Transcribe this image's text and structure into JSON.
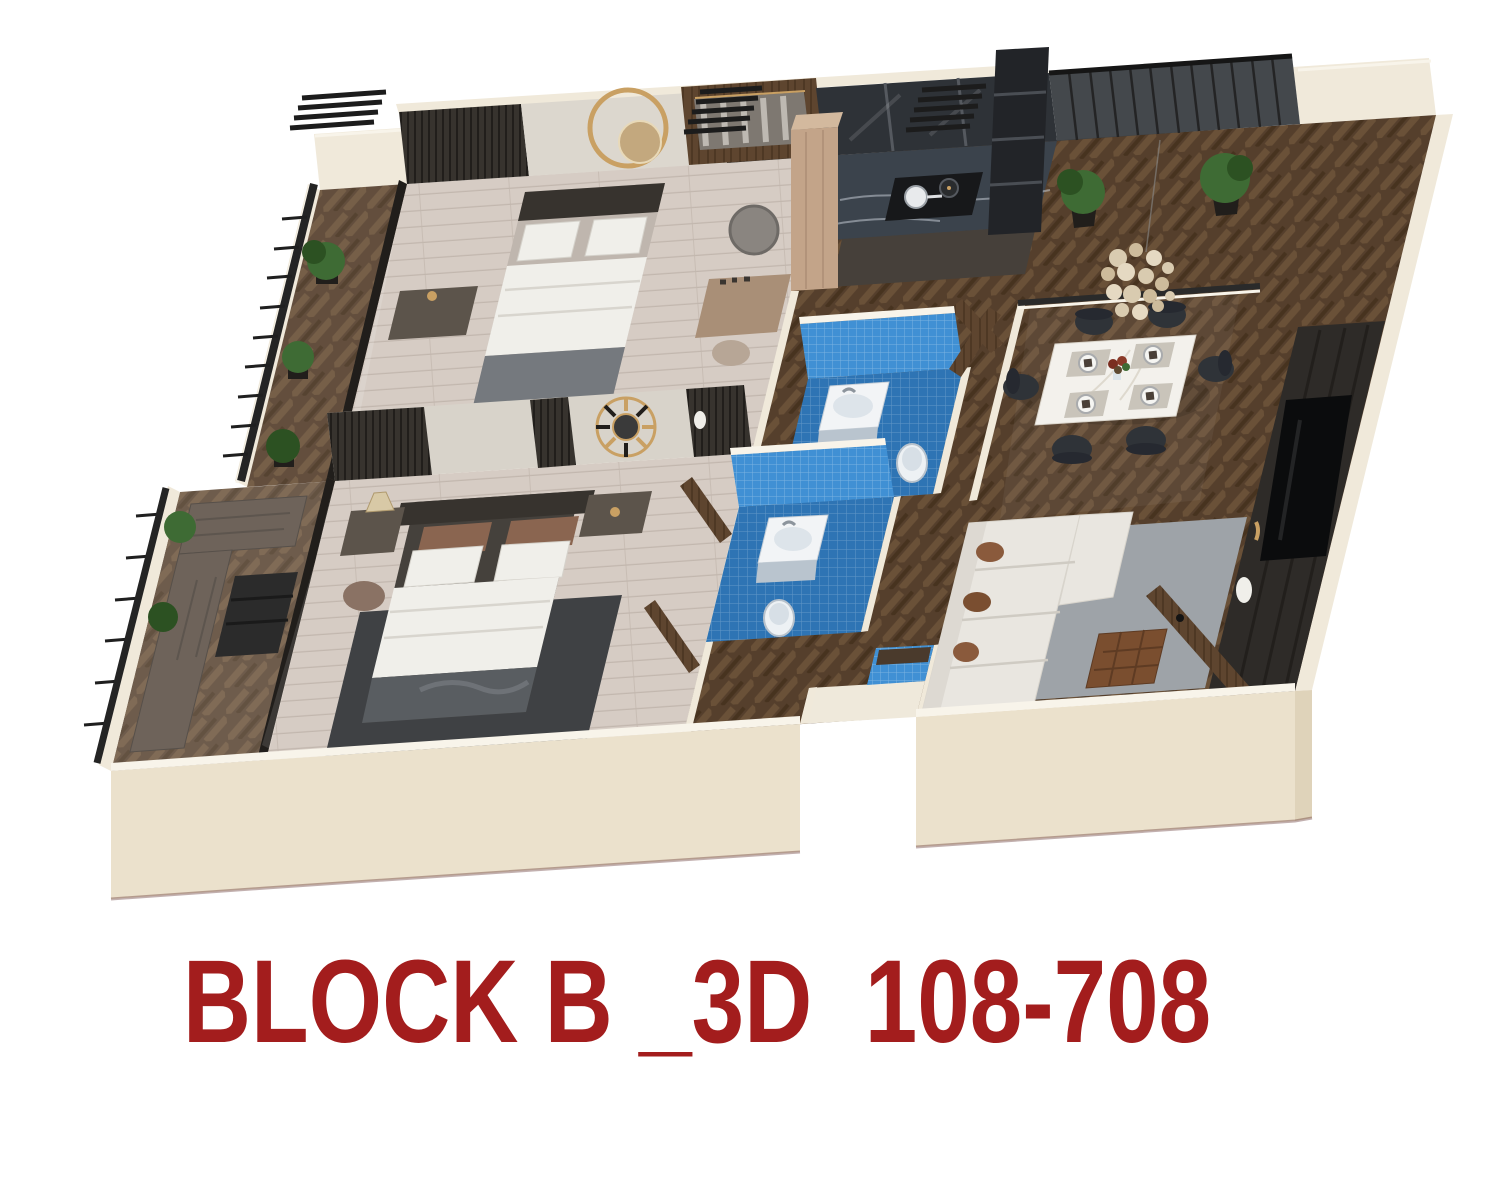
{
  "title": {
    "label": "BLOCK B _3D  108-708"
  },
  "colors": {
    "red": "#A31D1D",
    "wall": "#F0E9DA",
    "wallFront": "#EBE1CC",
    "wallSide": "#DFD3BA",
    "wallCap": "#F8F4EA",
    "floorLight": "#D6CCC4",
    "plankLine": "#C2B7AE",
    "herr1": "#553F2C",
    "herr2": "#6A5138",
    "herr3": "#47331F",
    "tile": "#2E74B4",
    "tileLight": "#4090D4",
    "dark": "#37332E",
    "darker": "#211E1B",
    "black": "#1B1B1C",
    "wood": "#5E452F",
    "woodGray": "#6E635A",
    "beige": "#C3A489",
    "gold": "#C9A063",
    "white": "#F0EFEA",
    "softGray": "#9EA3A8",
    "brown": "#8A5A3C",
    "green": "#3E6B34",
    "greenDark": "#2C5122",
    "counter": "#3B434C",
    "sofa": "#E9E6E0",
    "rugDark": "#3F4144",
    "marble": "#F3F1EC",
    "chair": "#2F3338",
    "cream": "#EFE9DB",
    "blanket": "#75797E",
    "glassDark": "#3A3E42",
    "mirror": "#8A8580",
    "pendant": "#D9CBB0",
    "bedGray": "#595D61",
    "pillowBrown": "#8A6550",
    "nightstand": "#5C544B"
  },
  "scene": {
    "type": "isometric-3d-floor-plan",
    "rooms": [
      "bedroom-1",
      "master-bedroom",
      "kitchen",
      "dining-area",
      "living-room",
      "bathroom-1",
      "bathroom-2",
      "balcony-1",
      "balcony-2",
      "master-balcony",
      "entry"
    ]
  }
}
